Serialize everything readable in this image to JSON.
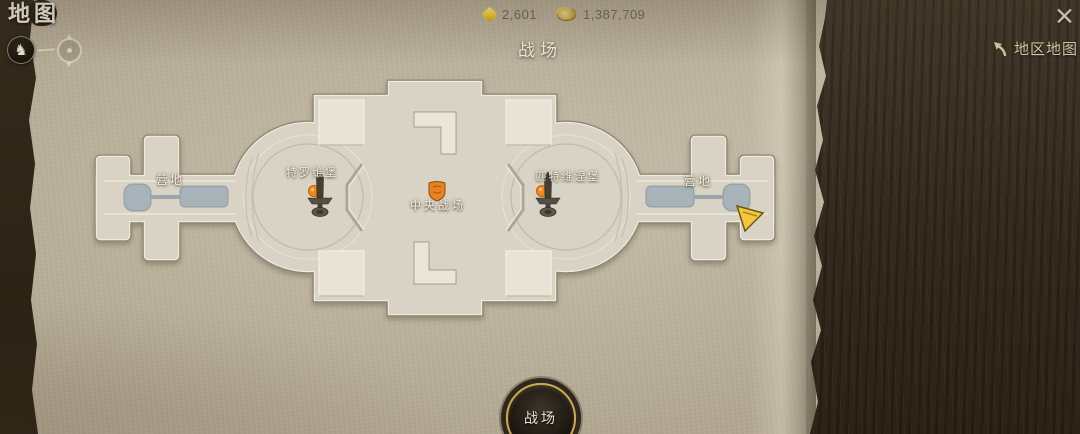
{
  "app": {
    "screen_title": "地图",
    "page_title": "战场"
  },
  "header": {
    "currencies": [
      {
        "name": "diamond",
        "value": "2,601"
      },
      {
        "name": "gold",
        "value": "1,387,709"
      }
    ]
  },
  "top_right": {
    "region_map_label": "地区地图"
  },
  "icons": {
    "close": "✕",
    "horse": "♞"
  },
  "map": {
    "left_camp_label": "营地",
    "right_camp_label": "营地",
    "left_fort_label": "特罗维堡",
    "right_fort_label": "匹特维涅堡",
    "center_label": "中央战场"
  },
  "footer": {
    "mode_button_label": "战场"
  },
  "colors": {
    "accent_gold": "#c9a84e",
    "marker_orange": "#e8821e",
    "spawn_blue": "#a7b2b9",
    "player_arrow_yellow": "#f3c83c",
    "parchment": "#b0a690",
    "wood_panel": "#332a1d"
  }
}
